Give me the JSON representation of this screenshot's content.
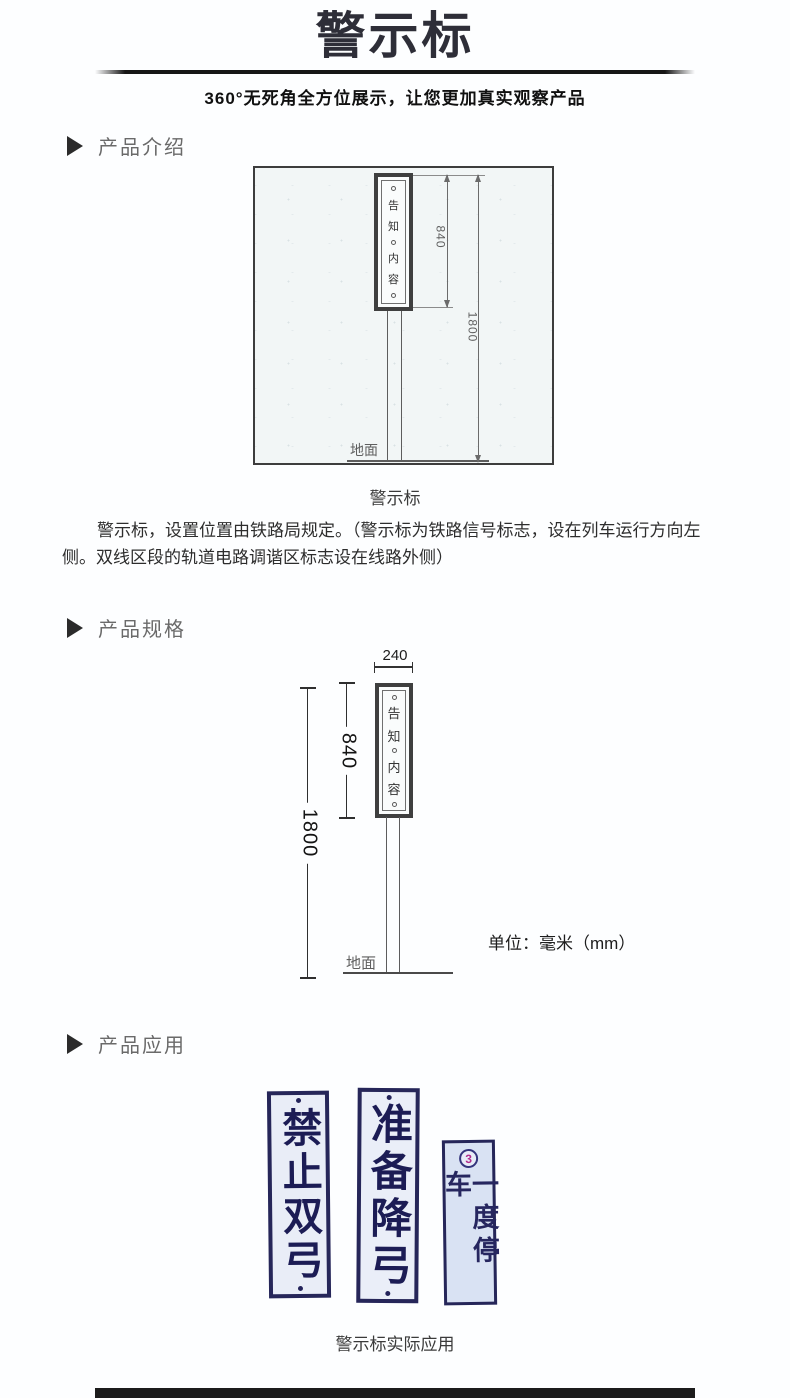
{
  "header": {
    "title": "警示标",
    "subtitle": "360°无死角全方位展示，让您更加真实观察产品"
  },
  "sections": {
    "intro": "产品介绍",
    "spec": "产品规格",
    "app": "产品应用"
  },
  "board": {
    "chars": [
      "告",
      "知",
      "内",
      "容"
    ]
  },
  "diagram1": {
    "board_height": "840",
    "total_height": "1800",
    "ground_label": "地面",
    "caption": "警示标"
  },
  "intro_paragraph": "警示标，设置位置由铁路局规定。（警示标为铁路信号标志，设在列车运行方向左侧。双线区段的轨道电路调谐区标志设在线路外侧）",
  "diagram2": {
    "board_width": "240",
    "board_height": "840",
    "total_height": "1800",
    "ground_label": "地面",
    "unit_note": "单位：毫米（mm）"
  },
  "application": {
    "signs": [
      {
        "text": "禁止双弓"
      },
      {
        "text": "准备降弓"
      },
      {
        "text": "一度停车",
        "badge": "3"
      }
    ],
    "caption": "警示标实际应用"
  },
  "colors": {
    "title_ink": "#2e2e38",
    "divider": "#161616",
    "section_label": "#6a6a6a",
    "drawing_line": "#5d5d5d",
    "sign_navy": "#23235a",
    "sign_background": "#e9edf7",
    "badge_magenta": "#b02a8c"
  }
}
